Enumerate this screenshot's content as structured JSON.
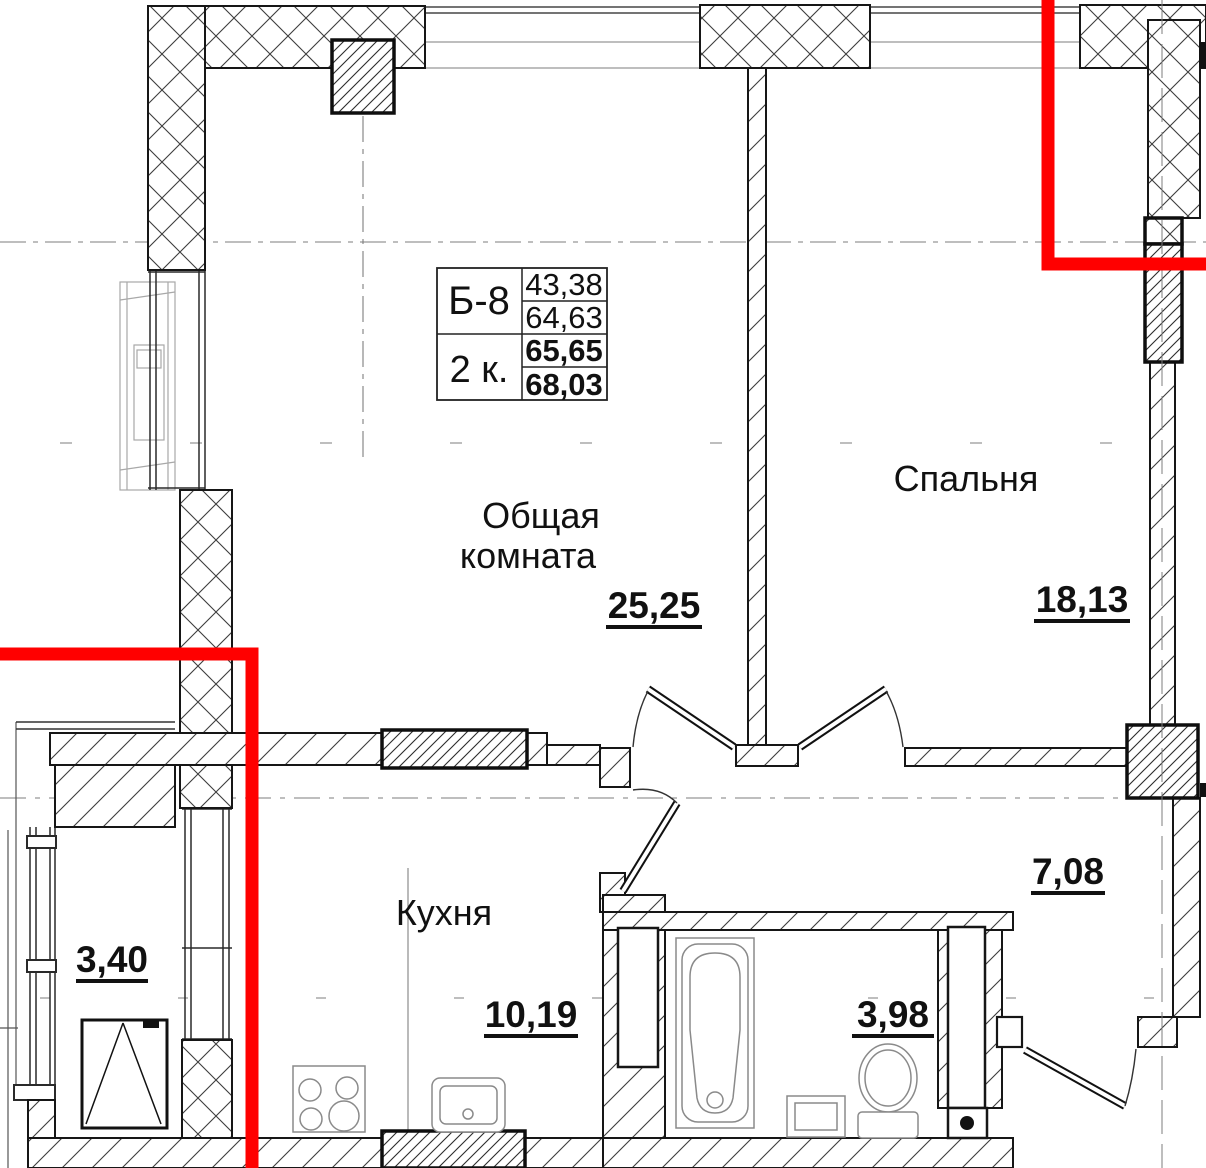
{
  "unit_card": {
    "code": "Б-8",
    "type": "2 к.",
    "area_living": "43,38",
    "area_rooms": "64,63",
    "area_total": "65,65",
    "area_with_balcony": "68,03"
  },
  "rooms": {
    "living": {
      "line1": "Общая",
      "line2": "комната",
      "area": "25,25"
    },
    "bedroom": {
      "name": "Спальня",
      "area": "18,13"
    },
    "kitchen": {
      "name": "Кухня",
      "area": "10,19"
    },
    "hall": {
      "area": "7,08"
    },
    "bathroom": {
      "area": "3,98"
    },
    "balcony": {
      "area": "3,40"
    }
  },
  "colors": {
    "section_line": "#ff0000",
    "wall_line": "#161616",
    "hatch": "#3d3d3d",
    "axis": "#7d7d7d",
    "fixture": "#8a8a8a"
  }
}
